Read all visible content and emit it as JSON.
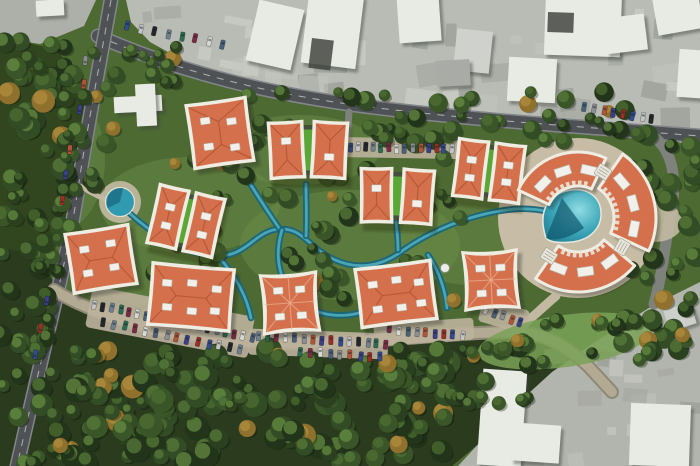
{
  "meta": {
    "kind": "aerial-masterplan-render",
    "canvas": {
      "w": 700,
      "h": 466
    }
  },
  "palette": {
    "grass_base": "#4d6a33",
    "grass_light": "#6d8f49",
    "forest_dark": "#2a3b1e",
    "tree_dark": [
      "#22351a",
      "#2a401f",
      "#324c25",
      "#3a5629"
    ],
    "tree_light": [
      "#4e7032",
      "#5a7d3a",
      "#689043"
    ],
    "tree_autumn": "#8f712d",
    "urban_gray": "#b9bcb4",
    "urban_gray2": "#b2b5ae",
    "white_building": "#e8eae4",
    "road_dark": "#4f5255",
    "road_edge": "#83868a",
    "road_beige": "#b3aa94",
    "road_beige_edge": "#8f8876",
    "path_beige": "#c3b9a2",
    "plaza_beige": "#c7bda6",
    "stream_dark": "#19657a",
    "stream_light": "#52b0c0",
    "pond_fill": "#2f9ab0",
    "pool_deep": "#12586e",
    "roof_orange": "#d5704c",
    "roof_ridge": "#ad5330",
    "roof_trim": "#efece2",
    "green_roof": "#5aa636",
    "green_roof_edge": "#2f3d24",
    "dormer": "#f2f0ea",
    "cars": [
      "#9b2f28",
      "#334b8f",
      "#c2c4c6",
      "#24272b",
      "#6f8190",
      "#2e6b54",
      "#7d2c47",
      "#d8d8d4",
      "#49617a",
      "#8c8f93",
      "#b0543a",
      "#3c3f8a"
    ]
  },
  "scene": {
    "ground": {
      "forest_bottom": "M0,246 L36,252 L56,286 L116,314 L214,336 L338,343 L462,335 L540,334 L582,352 L536,400 L476,446 L452,466 L0,466 Z",
      "forest_left": "M0,36 L58,50 L86,96 L76,170 L60,244 L24,252 L0,248 Z",
      "grass_patches": [
        {
          "cx": 190,
          "cy": 205,
          "rx": 90,
          "ry": 48
        },
        {
          "cx": 350,
          "cy": 245,
          "rx": 110,
          "ry": 55
        },
        {
          "cx": 470,
          "cy": 240,
          "rx": 70,
          "ry": 45
        },
        {
          "cx": 150,
          "cy": 265,
          "rx": 60,
          "ry": 40
        },
        {
          "cx": 300,
          "cy": 150,
          "rx": 80,
          "ry": 35
        },
        {
          "cx": 60,
          "cy": 160,
          "rx": 45,
          "ry": 70
        }
      ],
      "green_meadow_se": {
        "cx": 565,
        "cy": 341,
        "rx": 88,
        "ry": 26,
        "rot": -8,
        "fill": "#7aa257"
      }
    },
    "urban": {
      "top_area": "M126,0 L700,0 L700,148 L648,134 L560,128 L450,119 L340,107 L252,90 L186,62 L150,42 L131,22 Z",
      "bottom_right_area": "M700,282 L652,306 L592,344 L552,372 L506,414 L458,466 L700,466 Z",
      "top_left_corner": "M0,0 L96,0 L84,26 L40,44 L0,38 Z",
      "buildings_top": [
        {
          "x": 252,
          "y": 4,
          "w": 46,
          "h": 62,
          "rot": 13
        },
        {
          "x": 305,
          "y": -8,
          "w": 55,
          "h": 74,
          "rot": 7
        },
        {
          "x": 398,
          "y": -6,
          "w": 42,
          "h": 48,
          "rot": -4
        },
        {
          "x": 455,
          "y": 30,
          "w": 36,
          "h": 42,
          "rot": 6,
          "fill": "#cfd2cc"
        },
        {
          "x": 545,
          "y": -10,
          "w": 76,
          "h": 66,
          "rot": 2
        },
        {
          "x": 508,
          "y": 58,
          "w": 48,
          "h": 44,
          "rot": 3
        },
        {
          "x": 604,
          "y": 16,
          "w": 42,
          "h": 36,
          "rot": -7
        },
        {
          "x": 655,
          "y": -6,
          "w": 46,
          "h": 38,
          "rot": -10
        },
        {
          "x": 678,
          "y": 50,
          "w": 34,
          "h": 48,
          "rot": 4
        },
        {
          "x": 436,
          "y": 60,
          "w": 34,
          "h": 26,
          "rot": -3,
          "fill": "#a9aca6"
        }
      ],
      "dark_roofs": [
        {
          "x": 312,
          "y": 38,
          "w": 22,
          "h": 30,
          "rot": 7
        },
        {
          "x": 548,
          "y": 12,
          "w": 26,
          "h": 20,
          "rot": 2
        }
      ],
      "buildings_bottom_right": [
        {
          "x": 480,
          "y": 370,
          "w": 44,
          "h": 96,
          "rot": 4
        },
        {
          "x": 512,
          "y": 424,
          "w": 48,
          "h": 38,
          "rot": 4
        },
        {
          "x": 630,
          "y": 404,
          "w": 60,
          "h": 62,
          "rot": 2
        },
        {
          "x": 666,
          "y": 306,
          "w": 28,
          "h": 22,
          "rot": -18,
          "fill": "#cdd0ca"
        }
      ],
      "misc_white": [
        {
          "x": 36,
          "y": 0,
          "w": 28,
          "h": 16,
          "rot": -3
        },
        {
          "x": 114,
          "y": 96,
          "w": 48,
          "h": 16,
          "rot": -3
        },
        {
          "x": 136,
          "y": 84,
          "w": 20,
          "h": 42,
          "rot": -3
        }
      ],
      "noise_top": {
        "count": 46
      },
      "noise_bottom": {
        "count": 16
      }
    },
    "roads": [
      {
        "name": "road-top-main",
        "d": "M98,36 C180,72 270,96 395,110 C480,120 570,126 700,136",
        "w": 12,
        "type": "asphalt",
        "dash": true
      },
      {
        "name": "road-right-edge",
        "d": "M648,133 C672,146 678,176 671,212 C665,246 662,276 654,304",
        "w": 11,
        "type": "gray",
        "dash": false
      },
      {
        "name": "road-left",
        "d": "M111,0 C100,62 88,124 79,182 C71,238 60,282 48,332 C38,374 27,422 17,466",
        "w": 12,
        "type": "asphalt",
        "dash": true
      },
      {
        "name": "road-bottom-loop",
        "d": "M54,290 C82,308 124,322 172,332 C232,342 300,345 368,341 C428,337 472,332 514,332 C546,333 566,346 588,366 L612,392",
        "w": 10,
        "type": "beige",
        "dash": false
      },
      {
        "name": "parking-entry-top",
        "d": "M349,112 L347,142",
        "w": 7,
        "type": "gray",
        "dash": false
      },
      {
        "name": "plaza-connector",
        "d": "M516,331 C532,318 544,306 556,296",
        "w": 9,
        "type": "path",
        "dash": false
      },
      {
        "name": "pond-path",
        "d": "M80,186 C96,196 106,200 113,202",
        "w": 5,
        "type": "path",
        "dash": false
      }
    ],
    "streams": [
      "M122,206 C148,232 185,256 218,256 C248,256 255,230 280,229 C303,228 308,247 333,259 C358,271 382,266 402,251 C424,235 455,221 485,214 C510,208 528,207 550,212",
      "M219,257 C232,272 246,292 251,318",
      "M306,236 C307,218 306,200 306,184",
      "M398,250 C398,240 397,230 396,222",
      "M428,255 C438,270 445,288 447,308",
      "M243,172 C255,192 268,212 279,228",
      "M282,230 C272,262 283,294 307,307 C331,320 360,317 378,304",
      "M550,212 C560,214 566,219 570,223"
    ],
    "plaza": {
      "cx": 578,
      "cy": 218,
      "r": 80,
      "east_pad": {
        "cx": 655,
        "cy": 222,
        "rx": 28,
        "ry": 20
      }
    },
    "pond": {
      "cx": 120,
      "cy": 202,
      "r": 14.5,
      "pad_r": 21
    },
    "pool": {
      "outline": "M546,238 C538,214 546,196 566,191 C586,186 600,196 601,212 C602,228 590,240 572,242 C561,243 550,243 546,238 Z",
      "deep_wedge": "M546,238 L562,198 L584,228 C570,238 554,242 546,238 Z"
    },
    "parking_pads": [
      {
        "cx": 397,
        "cy": 148,
        "w": 124,
        "h": 20,
        "rot": 1
      },
      {
        "cx": 170,
        "cy": 322,
        "w": 165,
        "h": 42,
        "rot": 11
      },
      {
        "cx": 318,
        "cy": 344,
        "w": 140,
        "h": 26,
        "rot": 2
      },
      {
        "cx": 424,
        "cy": 332,
        "w": 100,
        "h": 22,
        "rot": -4
      },
      {
        "cx": 504,
        "cy": 316,
        "w": 48,
        "h": 24,
        "rot": 16
      }
    ],
    "parking_rows": [
      {
        "x1": 342,
        "y1": 147,
        "x2": 452,
        "y2": 149,
        "n": 15,
        "perp": true
      },
      {
        "x1": 128,
        "y1": 26,
        "x2": 222,
        "y2": 44,
        "n": 8,
        "perp": true
      },
      {
        "x1": 94,
        "y1": 305,
        "x2": 252,
        "y2": 337,
        "n": 19,
        "perp": true
      },
      {
        "x1": 104,
        "y1": 322,
        "x2": 240,
        "y2": 350,
        "n": 14,
        "perp": true
      },
      {
        "x1": 258,
        "y1": 336,
        "x2": 386,
        "y2": 344,
        "n": 15,
        "perp": true
      },
      {
        "x1": 300,
        "y1": 352,
        "x2": 380,
        "y2": 357,
        "n": 9,
        "perp": true
      },
      {
        "x1": 390,
        "y1": 329,
        "x2": 462,
        "y2": 336,
        "n": 9,
        "perp": true
      },
      {
        "x1": 486,
        "y1": 310,
        "x2": 520,
        "y2": 322,
        "n": 5,
        "perp": true
      },
      {
        "x1": 585,
        "y1": 107,
        "x2": 652,
        "y2": 119,
        "n": 8,
        "perp": true
      },
      {
        "x1": 86,
        "y1": 60,
        "x2": 80,
        "y2": 110,
        "n": 3,
        "perp": false
      },
      {
        "x1": 70,
        "y1": 150,
        "x2": 63,
        "y2": 200,
        "n": 3,
        "perp": false
      },
      {
        "x1": 46,
        "y1": 300,
        "x2": 36,
        "y2": 355,
        "n": 3,
        "perp": false
      }
    ],
    "tree_regions": [
      {
        "x": 0,
        "y": 340,
        "w": 150,
        "h": 126,
        "n": 58,
        "rmin": 6,
        "rmax": 13
      },
      {
        "x": 150,
        "y": 350,
        "w": 310,
        "h": 114,
        "n": 105,
        "rmin": 6,
        "rmax": 13
      },
      {
        "x": 0,
        "y": 250,
        "w": 62,
        "h": 96,
        "n": 20,
        "rmin": 6,
        "rmax": 11
      },
      {
        "x": 460,
        "y": 348,
        "w": 80,
        "h": 58,
        "n": 12,
        "rmin": 5,
        "rmax": 10
      },
      {
        "x": 0,
        "y": 40,
        "w": 75,
        "h": 215,
        "n": 48,
        "rmin": 6,
        "rmax": 12
      },
      {
        "x": 55,
        "y": 85,
        "w": 70,
        "h": 130,
        "n": 20,
        "rmin": 5,
        "rmax": 10
      },
      {
        "x": 200,
        "y": 92,
        "w": 430,
        "h": 52,
        "n": 52,
        "rmin": 5,
        "rmax": 10
      },
      {
        "x": 140,
        "y": 155,
        "w": 360,
        "h": 150,
        "n": 66,
        "rmin": 5,
        "rmax": 10
      },
      {
        "x": 630,
        "y": 130,
        "w": 68,
        "h": 110,
        "n": 18,
        "rmin": 6,
        "rmax": 11
      },
      {
        "x": 612,
        "y": 250,
        "w": 86,
        "h": 105,
        "n": 22,
        "rmin": 6,
        "rmax": 11
      },
      {
        "x": 470,
        "y": 318,
        "w": 180,
        "h": 44,
        "n": 20,
        "rmin": 5,
        "rmax": 9
      },
      {
        "x": 90,
        "y": 40,
        "w": 130,
        "h": 45,
        "n": 13,
        "rmin": 5,
        "rmax": 9
      }
    ],
    "buildings_square": [
      {
        "id": "villa-1",
        "cx": 220,
        "cy": 133,
        "w": 56,
        "h": 60,
        "rot": -8,
        "pinch": 1.5,
        "ridge": "h",
        "dormers": [
          [
            -13,
            -14
          ],
          [
            13,
            -10
          ],
          [
            -13,
            12
          ],
          [
            13,
            16
          ]
        ]
      },
      {
        "id": "villa-2",
        "cx": 101,
        "cy": 259,
        "w": 60,
        "h": 56,
        "rot": -9,
        "pinch": 1.5,
        "ridge": "h",
        "dormers": [
          [
            -15,
            -12
          ],
          [
            12,
            -14
          ],
          [
            -15,
            12
          ],
          [
            12,
            10
          ]
        ]
      },
      {
        "id": "villa-3",
        "cx": 191,
        "cy": 297,
        "w": 78,
        "h": 58,
        "rot": 5,
        "pinch": 1.5,
        "ridge": "h",
        "dormers": [
          [
            -25,
            -12
          ],
          [
            0,
            -14
          ],
          [
            25,
            -10
          ],
          [
            -23,
            12
          ],
          [
            2,
            14
          ],
          [
            25,
            12
          ]
        ]
      },
      {
        "id": "villa-4",
        "cx": 290,
        "cy": 303,
        "w": 52,
        "h": 55,
        "rot": -4,
        "pinch": 5,
        "ridge": "cross",
        "dormers": [
          [
            -11,
            -13
          ],
          [
            11,
            -13
          ],
          [
            -11,
            13
          ],
          [
            11,
            13
          ]
        ]
      },
      {
        "id": "villa-5",
        "cx": 396,
        "cy": 294,
        "w": 72,
        "h": 55,
        "rot": -7,
        "pinch": 1.5,
        "ridge": "h",
        "dormers": [
          [
            -22,
            -12
          ],
          [
            2,
            -14
          ],
          [
            24,
            -9
          ],
          [
            -20,
            13
          ],
          [
            4,
            14
          ],
          [
            24,
            12
          ]
        ]
      },
      {
        "id": "villa-6",
        "cx": 491,
        "cy": 280,
        "w": 50,
        "h": 54,
        "rot": -3,
        "pinch": 5,
        "ridge": "cross",
        "dormers": [
          [
            -10,
            -12
          ],
          [
            10,
            -12
          ],
          [
            -10,
            13
          ],
          [
            10,
            13
          ]
        ]
      }
    ],
    "buildings_pair": [
      {
        "id": "pair-1",
        "cx": 308,
        "cy": 150,
        "rot": 0,
        "bw": 30,
        "bh": 52,
        "gap": 13,
        "fan": 3,
        "dL": [
          [
            0,
            -9
          ]
        ],
        "dR": [
          [
            0,
            7
          ]
        ]
      },
      {
        "id": "pair-2",
        "cx": 397,
        "cy": 196,
        "rot": 2,
        "bw": 27,
        "bh": 50,
        "gap": 14,
        "fan": 2,
        "dL": [
          [
            0,
            -7
          ]
        ],
        "dR": [
          [
            0,
            7
          ]
        ]
      },
      {
        "id": "pair-3",
        "cx": 489,
        "cy": 171,
        "rot": 7,
        "bw": 26,
        "bh": 54,
        "gap": 11,
        "fan": 0,
        "dL": [
          [
            0,
            -9
          ],
          [
            0,
            9
          ]
        ],
        "dR": [
          [
            0,
            -8
          ],
          [
            0,
            9
          ]
        ]
      },
      {
        "id": "pair-4",
        "cx": 186,
        "cy": 221,
        "rot": 13,
        "bw": 26,
        "bh": 56,
        "gap": 11,
        "fan": 0,
        "dL": [
          [
            0,
            -10
          ],
          [
            0,
            9
          ]
        ],
        "dR": [
          [
            0,
            -9
          ],
          [
            0,
            10
          ]
        ]
      }
    ],
    "buildings_arc": [
      {
        "id": "arc-north",
        "cx": 578,
        "cy": 218,
        "r0": 32,
        "r1": 66,
        "a0": 205,
        "a1": 295,
        "hatches": [
          224,
          252,
          283
        ]
      },
      {
        "id": "arc-east",
        "cx": 578,
        "cy": 218,
        "r0": 36,
        "r1": 78,
        "a0": 305,
        "a1": 385,
        "hatches": [
          320,
          345,
          371
        ]
      },
      {
        "id": "arc-south",
        "cx": 578,
        "cy": 218,
        "r0": 34,
        "r1": 74,
        "a0": 40,
        "a1": 125,
        "hatches": [
          54,
          82,
          111
        ]
      }
    ],
    "stairs": [
      {
        "x": 603,
        "y": 172,
        "rot": 32
      },
      {
        "x": 622,
        "y": 247,
        "rot": 120
      },
      {
        "x": 549,
        "y": 256,
        "rot": 212
      }
    ],
    "gazebo": {
      "cx": 445,
      "cy": 268,
      "r": 4.5
    }
  }
}
